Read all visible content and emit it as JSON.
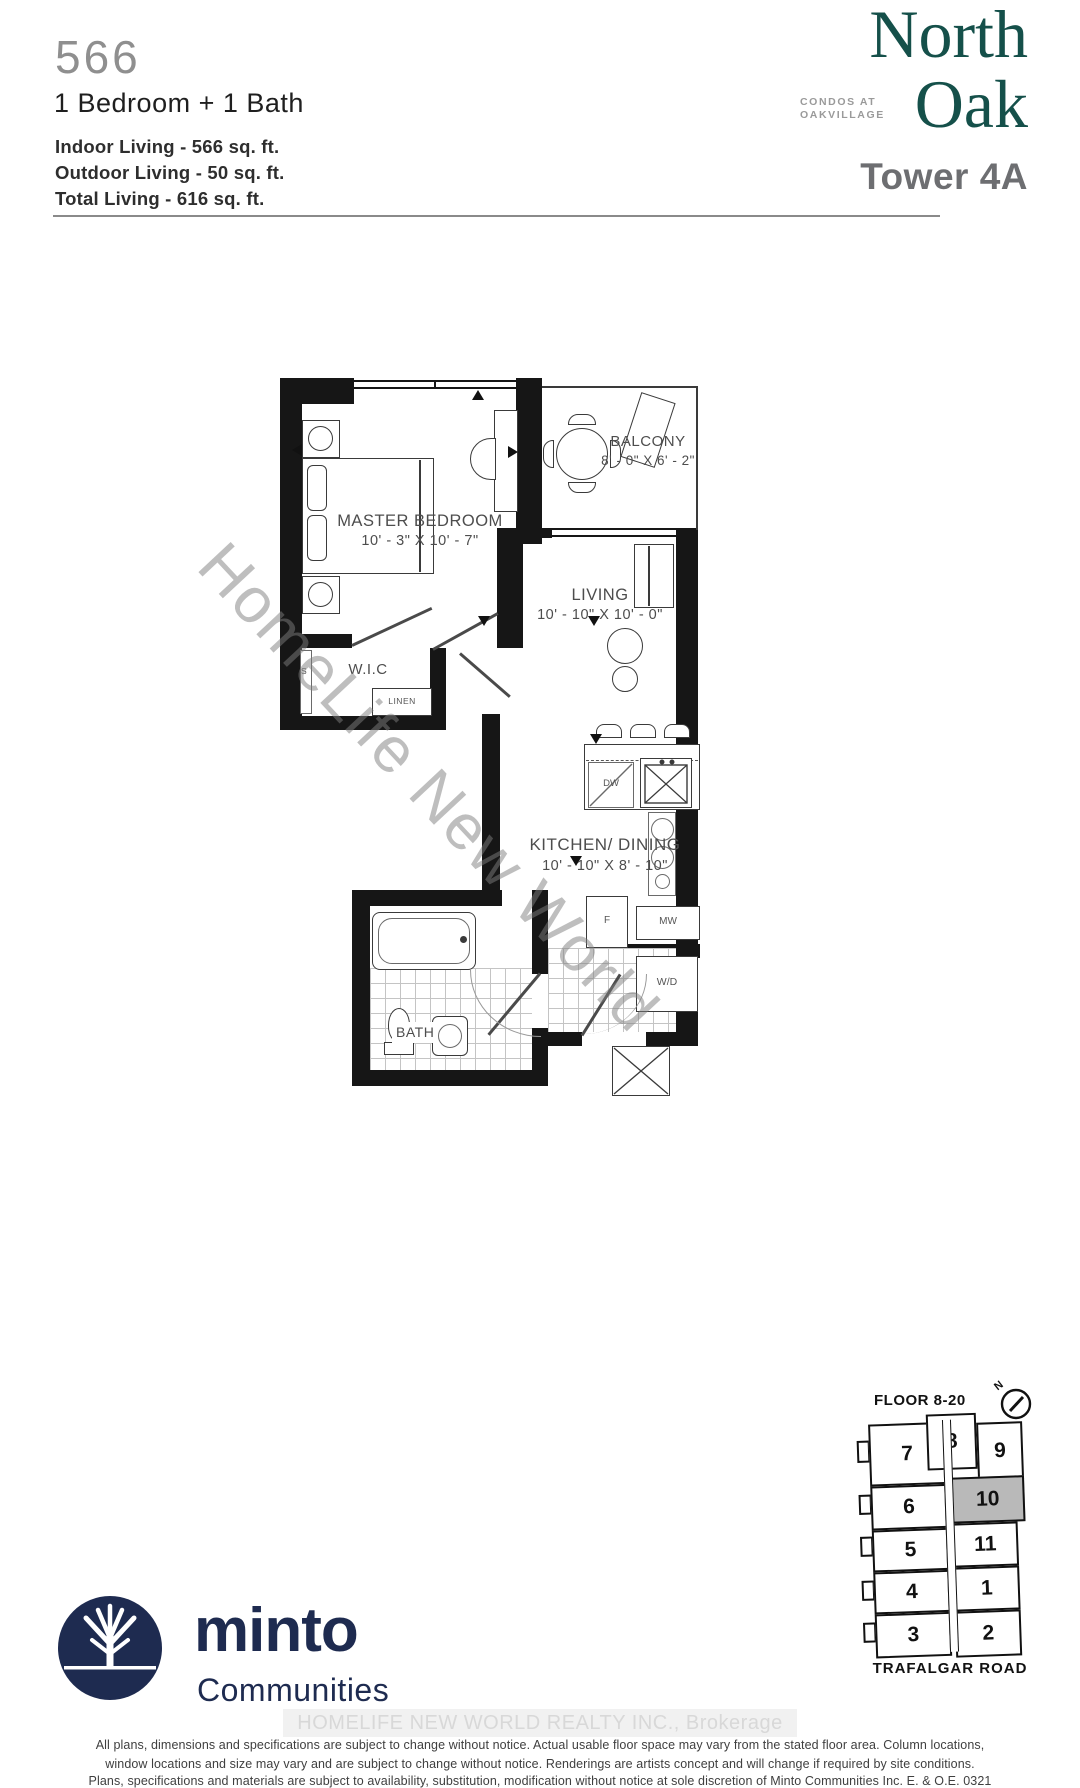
{
  "header": {
    "unit_number": "566",
    "unit_type": "1 Bedroom + 1 Bath",
    "indoor": "Indoor Living - 566 sq. ft.",
    "outdoor": "Outdoor Living - 50 sq. ft.",
    "total": "Total Living - 616 sq. ft."
  },
  "brand": {
    "name_line1": "North",
    "name_line2": "Oak",
    "sub_line1": "CONDOS AT",
    "sub_line2": "OAKVILLAGE",
    "tower": "Tower 4A"
  },
  "plan": {
    "rooms": {
      "master": {
        "name": "MASTER BEDROOM",
        "dims": "10' - 3\" X 10' - 7\""
      },
      "balcony": {
        "name": "BALCONY",
        "dims": "8' - 0\" X 6' - 2\""
      },
      "living": {
        "name": "LIVING",
        "dims": "10' - 10\" X 10' - 0\""
      },
      "wic": {
        "name": "W.I.C"
      },
      "kitchen": {
        "name": "KITCHEN/ DINING",
        "dims": "10' - 10\" X 8' - 10\""
      },
      "bath": {
        "name": "BATH"
      }
    },
    "fixtures": {
      "linen": "LINEN",
      "shelf": "S",
      "dishwasher": "DW",
      "fridge": "F",
      "microwave": "MW",
      "washer_dryer": "W/D"
    }
  },
  "watermark": {
    "diagonal": "HomeLife New World",
    "brokerage": "HOMELIFE NEW WORLD REALTY INC., Brokerage"
  },
  "keyplan": {
    "floor_label": "FLOOR 8-20",
    "road_label": "TRAFALGAR ROAD",
    "north_label": "N",
    "highlighted_unit": "10",
    "units": [
      {
        "label": "7"
      },
      {
        "label": "8"
      },
      {
        "label": "9"
      },
      {
        "label": "6"
      },
      {
        "label": "10"
      },
      {
        "label": "5"
      },
      {
        "label": "11"
      },
      {
        "label": "4"
      },
      {
        "label": "1"
      },
      {
        "label": "3"
      },
      {
        "label": "2"
      }
    ]
  },
  "developer": {
    "name": "minto",
    "division": "Communities"
  },
  "disclaimer": {
    "line1": "All plans, dimensions and specifications are subject to change without notice. Actual usable floor space may vary from the stated floor area. Column locations,",
    "line2": "window locations and size may vary and are subject to change without notice. Renderings are artists concept and will change if required by site conditions.",
    "line3": "Plans, specifications and materials are subject to availability, substitution, modification without notice at sole discretion of Minto Communities Inc.   E. & O.E. 0321"
  },
  "colors": {
    "brand_teal": "#15504a",
    "navy": "#1e2b50",
    "unit_gray": "#8f8f8f",
    "tower_gray": "#6d6e71",
    "kp_gray": "#b9b9b9"
  }
}
